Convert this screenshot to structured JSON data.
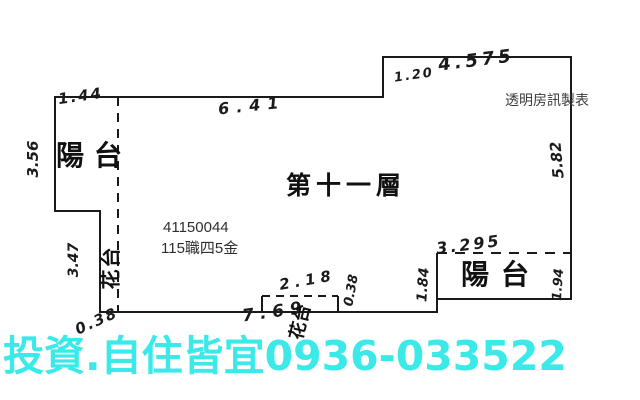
{
  "plan": {
    "floor_title": "第十一層",
    "maker_credit": "透明房訊製表",
    "id_code": "41150044",
    "id_label": "115職四5金",
    "rooms": {
      "balcony_top_left": "陽台",
      "planter_left": "花台",
      "planter_bottom": "花台",
      "balcony_bottom_right": "陽台"
    },
    "measurements": {
      "top_left_width": "1.44",
      "top_main_width": "6.41",
      "step_width": "1.20",
      "top_right_width": "4.575",
      "left_height": "3.56",
      "right_height": "5.82",
      "planter_left_height": "3.47",
      "planter_left_width": "0.38",
      "bottom_width": "7.69",
      "planter_bottom_width": "2.18",
      "planter_bottom_depth": "0.38",
      "balcony_left_step": "1.84",
      "balcony_width": "3.295",
      "balcony_right_height": "1.94"
    }
  },
  "banner": {
    "text": "投資.自住皆宜0936-033522",
    "color": "#3be9e9"
  },
  "colors": {
    "background": "#ffffff",
    "outline": "#1a1a1a",
    "print_text": "#2f2f2f",
    "banner_cyan": "#3be9e9"
  }
}
